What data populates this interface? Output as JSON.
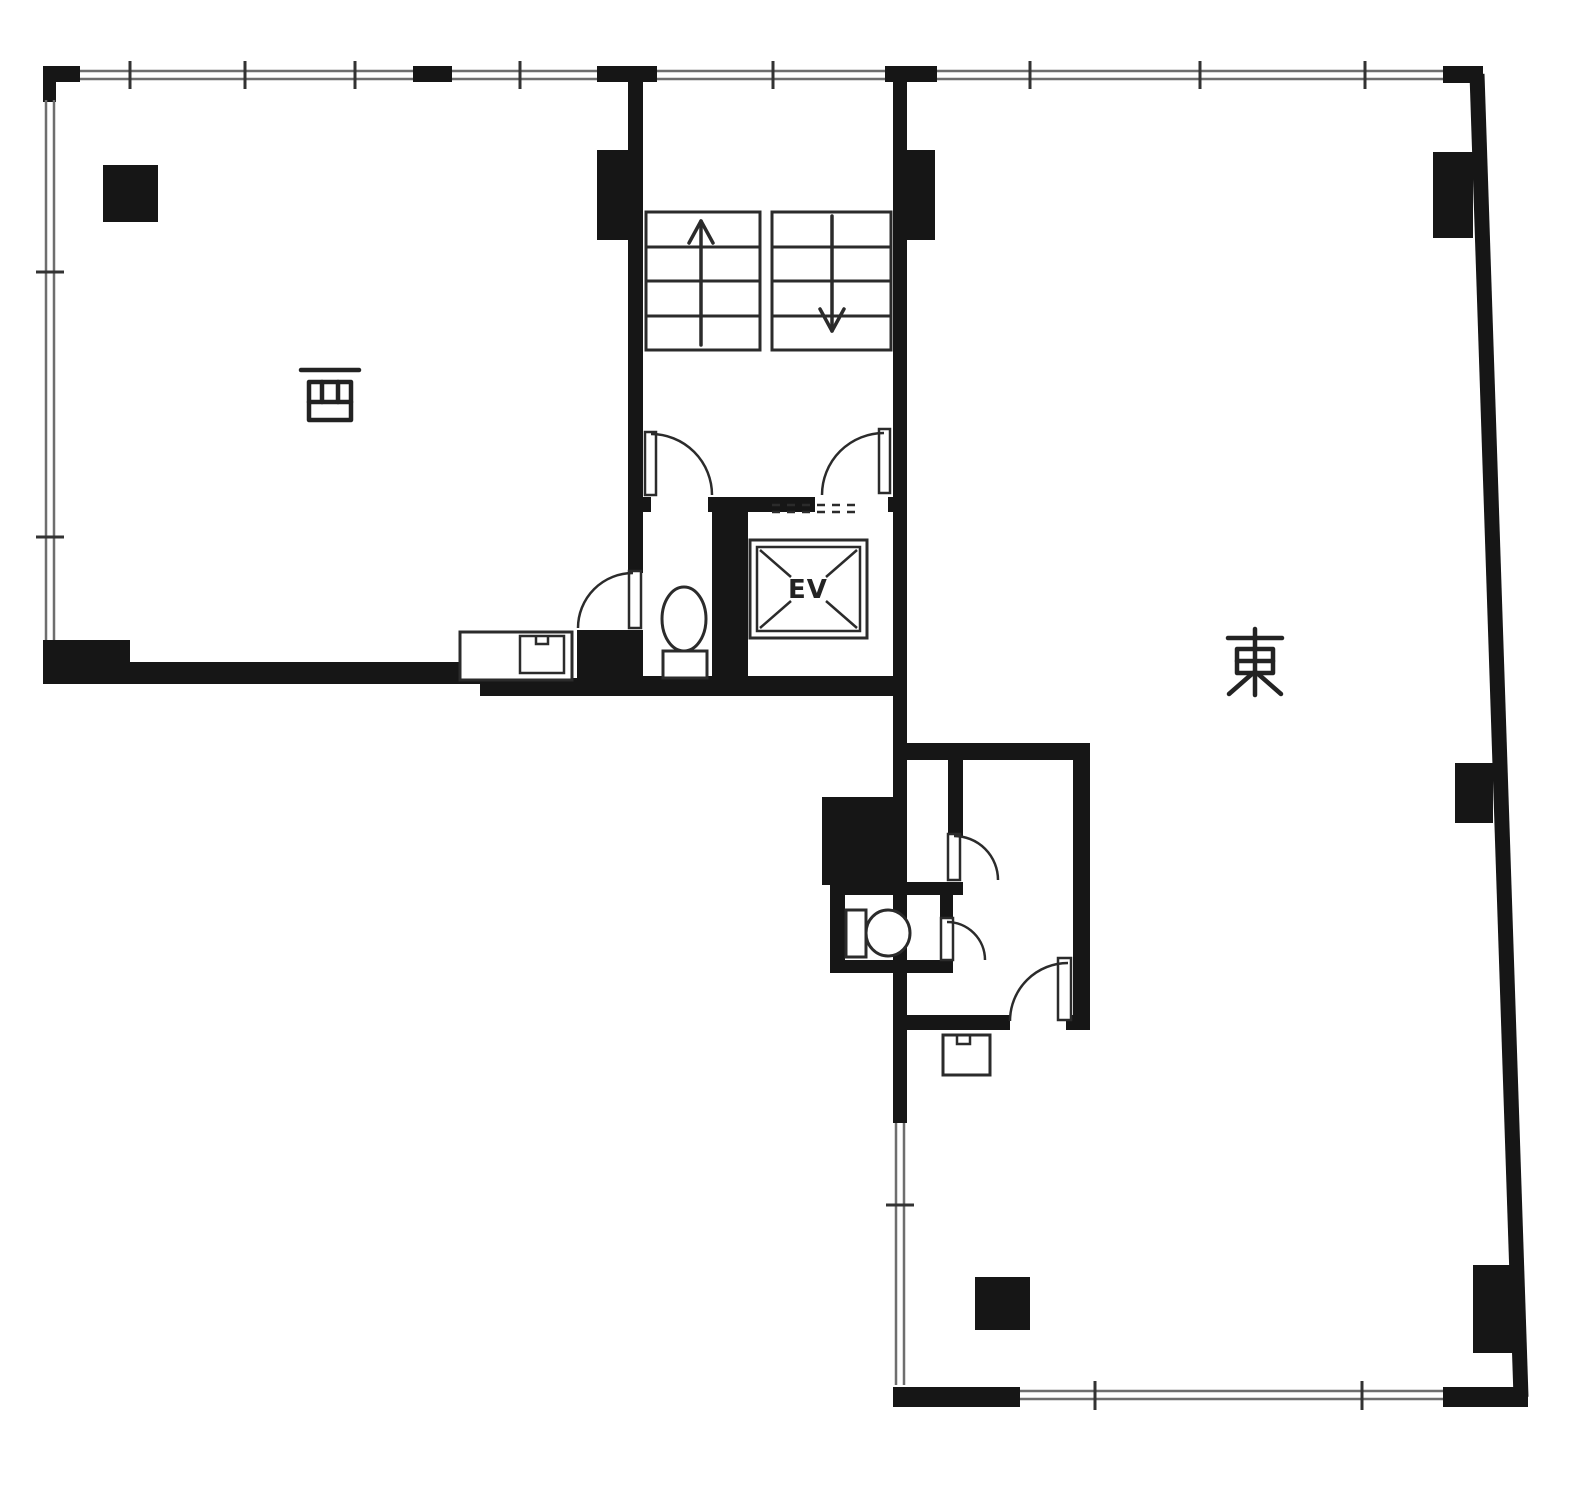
{
  "page": {
    "type": "architectural-floor-plan"
  },
  "labels": {
    "west_room": "西",
    "east_room": "東",
    "elevator": "EV"
  },
  "colors": {
    "wall": "#161616",
    "line": "#2b2b2b",
    "window": "#6e6e6e",
    "tick": "#333333",
    "background": "#ffffff",
    "text": "#232323"
  },
  "features": {
    "stairs": {
      "up_arrow": true,
      "down_arrow": true
    },
    "fixtures": [
      "elevator-cab",
      "toilet-core",
      "toilet-annex",
      "counter-sink",
      "hand-wash-sink"
    ]
  }
}
